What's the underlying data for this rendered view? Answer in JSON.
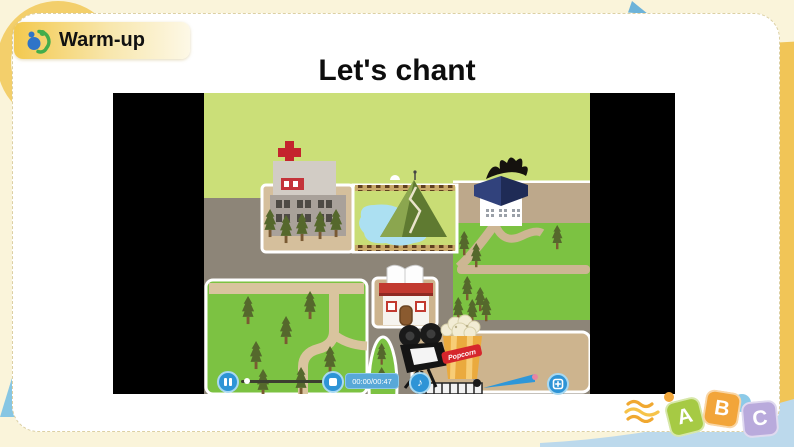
{
  "header": {
    "badge_label": "Warm-up",
    "title": "Let's chant"
  },
  "video": {
    "time_display": "00:00/00:47",
    "popcorn_label": "Popcorn",
    "scene_icons": [
      "hospital-building",
      "pond-park",
      "mountain",
      "museum-building",
      "library-building",
      "movie-camera",
      "popcorn-bucket",
      "cinema-courtyard",
      "trees",
      "roads"
    ],
    "colors": {
      "grass_light": "#cbdf78",
      "grass_bright": "#7cc242",
      "road_gray": "#8d8578",
      "road_tan": "#bda88b",
      "pond_blue": "#ace0f2",
      "button_blue": "#2e94d6"
    }
  },
  "decor": {
    "letter_blocks": [
      {
        "letter": "A",
        "color": "#a6ca44"
      },
      {
        "letter": "B",
        "color": "#f2a53a"
      },
      {
        "letter": "C",
        "color": "#b9aadc"
      }
    ],
    "page_bg": "#faf4da",
    "accent_gold": "#f2c94e",
    "band_blue": "#bcd9ec"
  }
}
